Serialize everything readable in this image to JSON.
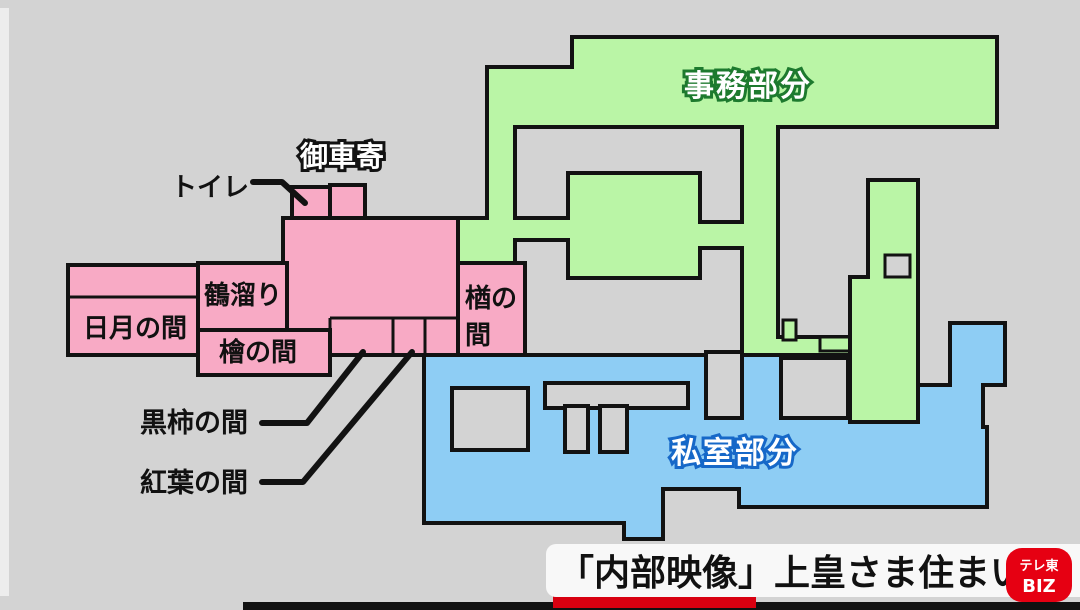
{
  "palette": {
    "background": "#d3d3d3",
    "office_green": "#baf5a6",
    "private_blue": "#8ecdf4",
    "reception_pink": "#f8aac5",
    "courtyard_gray": "#d3d3d3",
    "office_label_outline": "#1d7a2e",
    "private_label_outline": "#1668c8",
    "logo_red": "#e60012",
    "banner_bg": "#f8f8f8"
  },
  "zones": {
    "office": {
      "label": "事務部分"
    },
    "private": {
      "label": "私室部分"
    }
  },
  "rooms": {
    "porch": "御車寄",
    "toilet": "トイレ",
    "tsurudamari": "鶴溜り",
    "nichigetsu": "日月の間",
    "hinoki": "檜の間",
    "nara_line1": "楢の",
    "nara_line2": "間",
    "kurogaki": "黒柿の間",
    "momiji": "紅葉の間"
  },
  "banner": {
    "title": "「内部映像」上皇さま住まい",
    "logo_line1": "テレ東",
    "logo_line2": "BIZ"
  }
}
